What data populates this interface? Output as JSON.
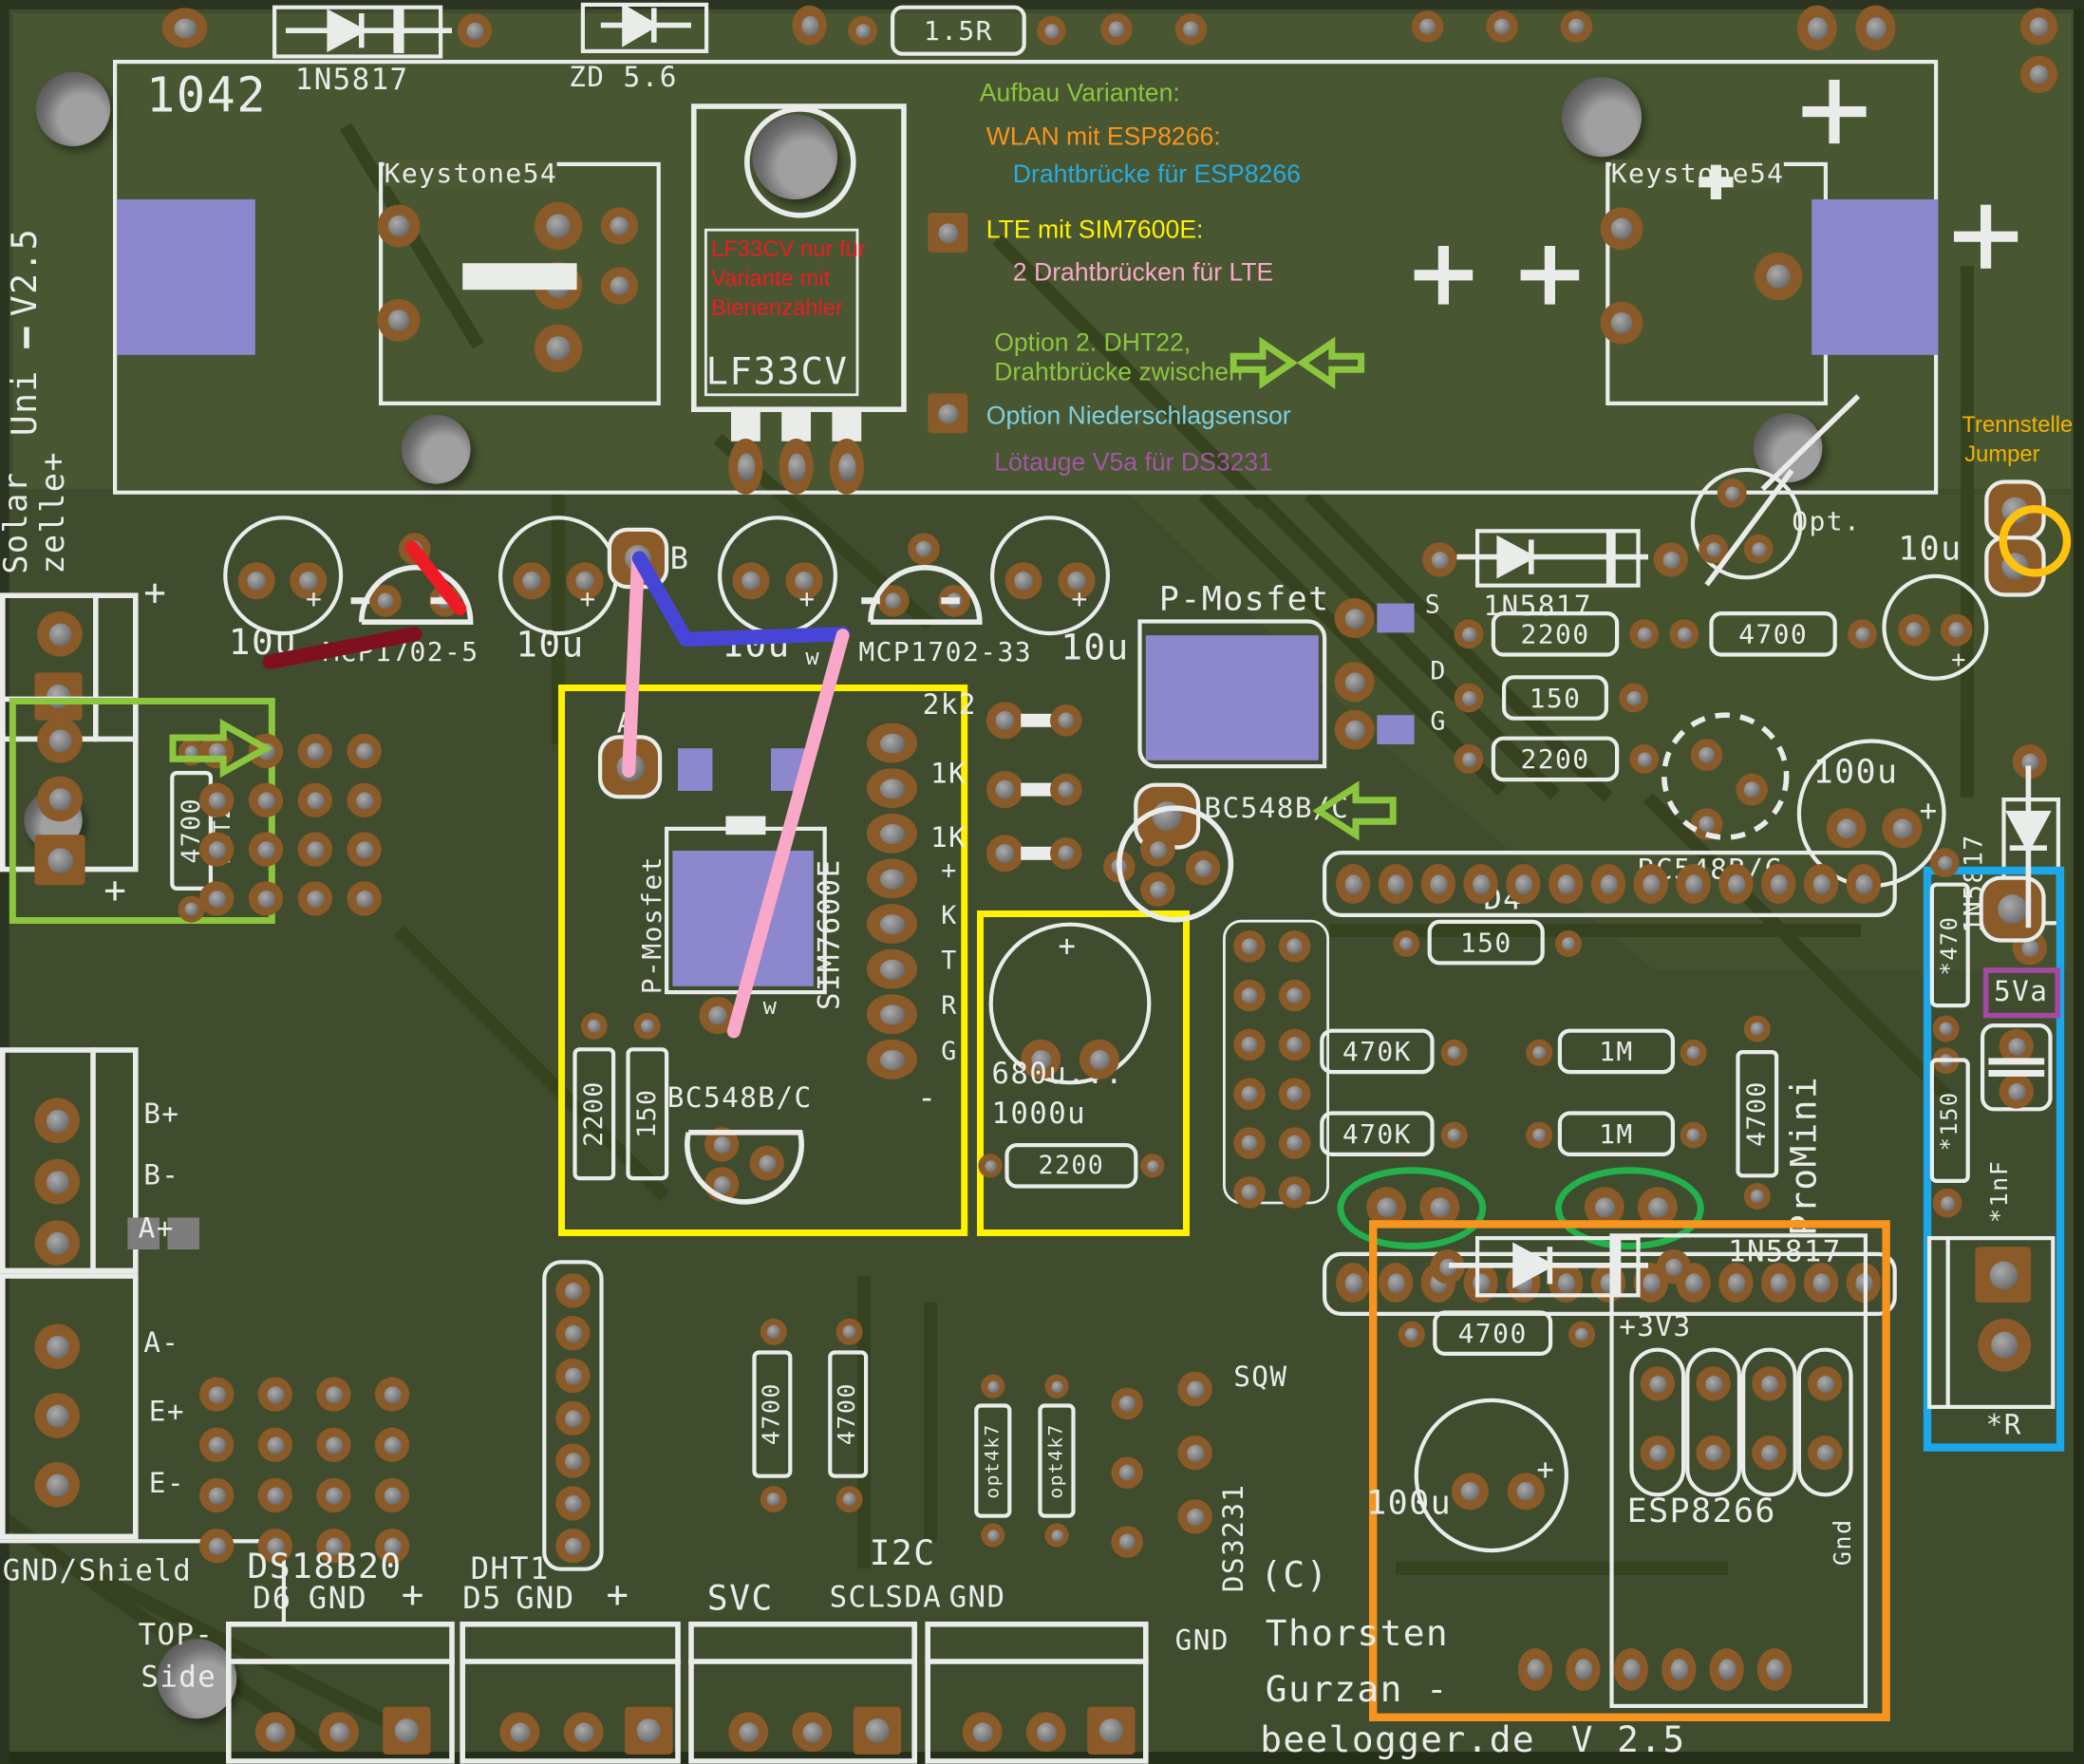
{
  "title": "beelogger Uni V2.5 PCB layout",
  "colors": {
    "board": "#3f4c2e",
    "pour": "#4c5933",
    "trace": "#36421f",
    "silkscreen": "#e9ece9",
    "copper_pad": "#8a5a28",
    "drill_hole": "#7d7d7d",
    "smd_component": "#8d87cd",
    "highlight_yellow": "#FFF200",
    "highlight_orange": "#F7941D",
    "highlight_blue": "#1BA7E8",
    "highlight_green": "#8CC63F",
    "highlight_ellipse_green": "#22B14C",
    "highlight_purple": "#A349A4",
    "highlight_gold": "#FFC20E",
    "wire_pink": "#F9A8C9",
    "wire_blue": "#4745D8",
    "wire_red": "#ED1C24",
    "wire_darkred": "#7E1020"
  },
  "sk": {
    "board_no": "1042",
    "d_schottky": "1N5817",
    "zd": "ZD 5.6",
    "keystone": "Keystone54",
    "lf33cv": "LF33CV",
    "r_1r5": "1.5R",
    "c10u": "10u",
    "mcp5": "MCP1702-5",
    "mcp33": "MCP1702-33",
    "pad_b": "B",
    "pad_a": "A",
    "pad_w": "w",
    "pmosfet": "P-Mosfet",
    "pin_s": "S",
    "pin_d": "D",
    "pin_g": "G",
    "sim7600": "SIM7600E",
    "pin_plus": "+",
    "pin_k": "K",
    "pin_t": "T",
    "pin_r": "R",
    "r2k2": "2k2",
    "r1k": "1K",
    "bc548": "BC548B/C",
    "r2200": "2200",
    "r150": "150",
    "r4700": "4700",
    "c680": "680u...",
    "c1000": "1000u",
    "opt": "Opt.",
    "c100u": "100u",
    "d4": "D4",
    "r470k": "470K",
    "r1m": "1M",
    "promini": "ProMini",
    "star470": "*470",
    "star150": "*150",
    "star1nf": "*1nF",
    "star_r": "*R",
    "v5a": "5Va",
    "p3v3": "+3V3",
    "esp8266": "ESP8266",
    "gnd_small": "Gnd",
    "sqw": "SQW",
    "ds3231": "DS3231",
    "gnd": "GND",
    "uni": "Uni",
    "v25": "V2.5",
    "solar": "Solar",
    "zelle": "zelle+",
    "bp": "B+",
    "bm": "B-",
    "ap": "A+",
    "am": "A-",
    "ep": "E+",
    "em": "E-",
    "gnd_shield": "GND/Shield",
    "top1": "TOP-",
    "top2": "Side",
    "ds18b20": "DS18B20",
    "d6": "D6",
    "d5": "D5",
    "dht1": "DHT1",
    "dht2": "DHT2",
    "svc": "SVC",
    "i2c": "I2C",
    "scl": "SCL",
    "sda": "SDA",
    "opt4k7": "opt4k7",
    "plus": "+",
    "minus": "-",
    "cc": "(C)",
    "name1": "Thorsten",
    "name2": "Gurzan -",
    "site": "beelogger.de",
    "ver": "V 2.5"
  },
  "ann": {
    "aufbau": {
      "text": "Aufbau Varianten:",
      "color": "#8CC63F"
    },
    "wlan": {
      "text": "WLAN mit ESP8266:",
      "color": "#F7931E"
    },
    "br_esp": {
      "text": "Drahtbrücke für ESP8266",
      "color": "#29ABE2"
    },
    "lte": {
      "text": "LTE mit SIM7600E:",
      "color": "#FFF200"
    },
    "br_lte": {
      "text": "2 Drahtbrücken für LTE",
      "color": "#F9A8C9"
    },
    "opt_dht": {
      "text": "Option 2. DHT22,",
      "color": "#8CC63F"
    },
    "br_zw": {
      "text": "Drahtbrücke zwischen",
      "color": "#8CC63F"
    },
    "nieder": {
      "text": "Option Niederschlagsensor",
      "color": "#7ECFE0"
    },
    "loet": {
      "text": "Lötauge V5a für DS3231",
      "color": "#A356A8"
    },
    "lf33_1": {
      "text": "LF33CV nur für",
      "color": "#ED1C24"
    },
    "lf33_2": {
      "text": "Variante mit",
      "color": "#ED1C24"
    },
    "lf33_3": {
      "text": "Bienenzähler",
      "color": "#ED1C24"
    },
    "trenn1": {
      "text": "Trennstelle",
      "color": "#F2B200"
    },
    "trenn2": {
      "text": "Jumper",
      "color": "#F2B200"
    }
  }
}
